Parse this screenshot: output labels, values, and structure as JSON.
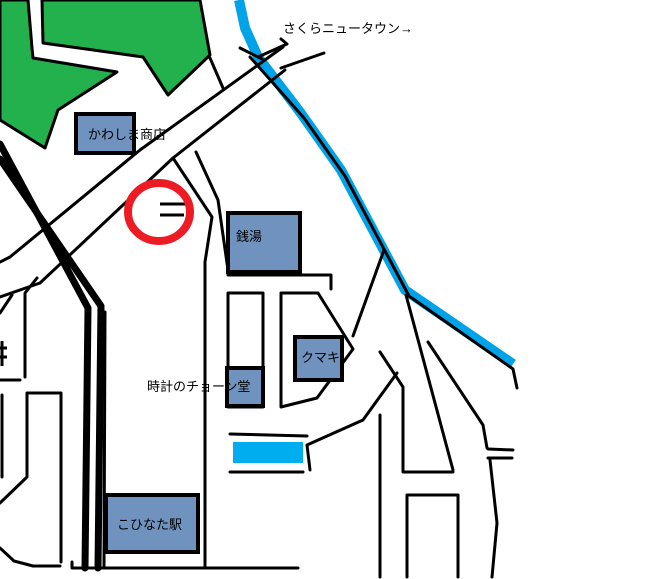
{
  "labels": {
    "sakura_newtown": "さくらニュータウン→",
    "kawashima_shoten": "かわしま商店",
    "sento": "銭湯",
    "kumaki": "クマキ",
    "tokei_chondo": "時計のチョーン堂",
    "kohinata_station": "こひなた駅"
  },
  "colors": {
    "park_green": "#22B14C",
    "river_blue": "#00A2E8",
    "pool_blue": "#00AEEF",
    "building_fill": "#7092BE",
    "highlight_red": "#ED1C24",
    "line_black": "#000000"
  }
}
